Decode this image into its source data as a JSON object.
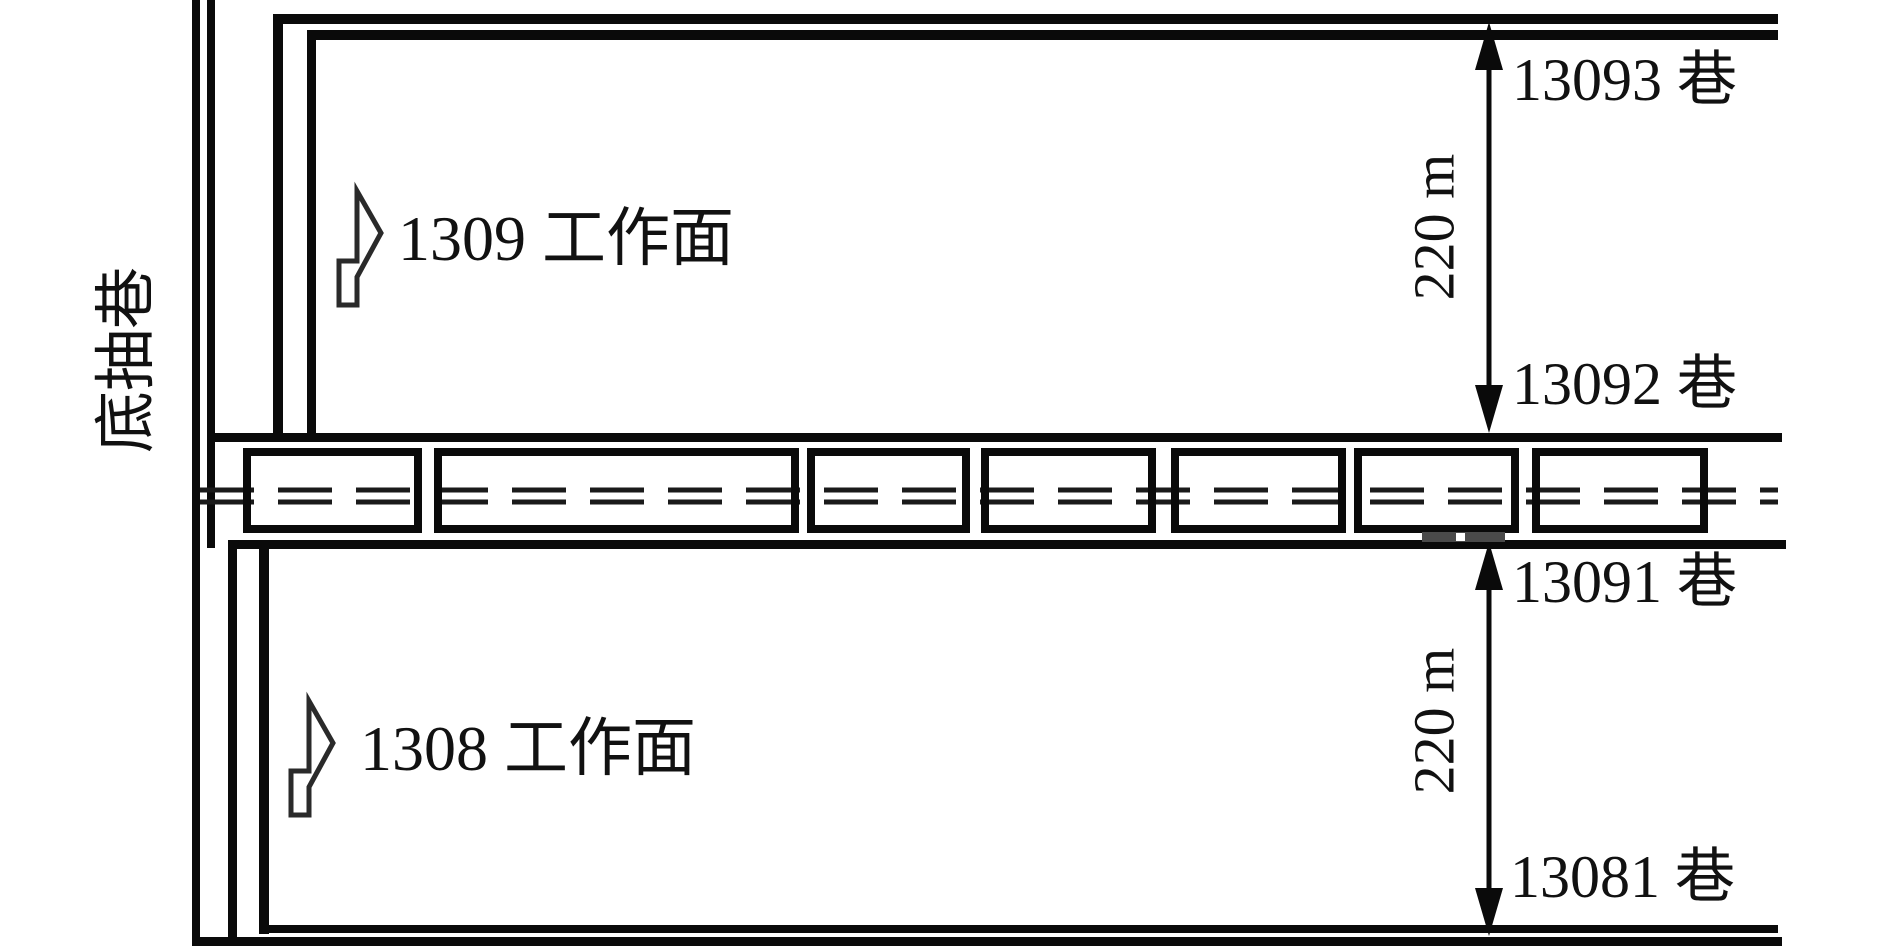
{
  "colors": {
    "background": "#ffffff",
    "line": "#0a0a0a",
    "text": "#111111",
    "equipment_bar": "#4a4a4a"
  },
  "left_roadway": {
    "label": "底抽巷"
  },
  "panels": {
    "upper": {
      "label": "1309 工作面"
    },
    "lower": {
      "label": "1308 工作面"
    }
  },
  "roadways": {
    "r13093": "13093 巷",
    "r13092": "13092 巷",
    "r13091": "13091 巷",
    "r13081": "13081 巷"
  },
  "dimensions": {
    "upper": "220 m",
    "lower": "220 m"
  },
  "gateway_supports": {
    "count": 7,
    "style": "rectangular supports with double dashed centerline"
  }
}
